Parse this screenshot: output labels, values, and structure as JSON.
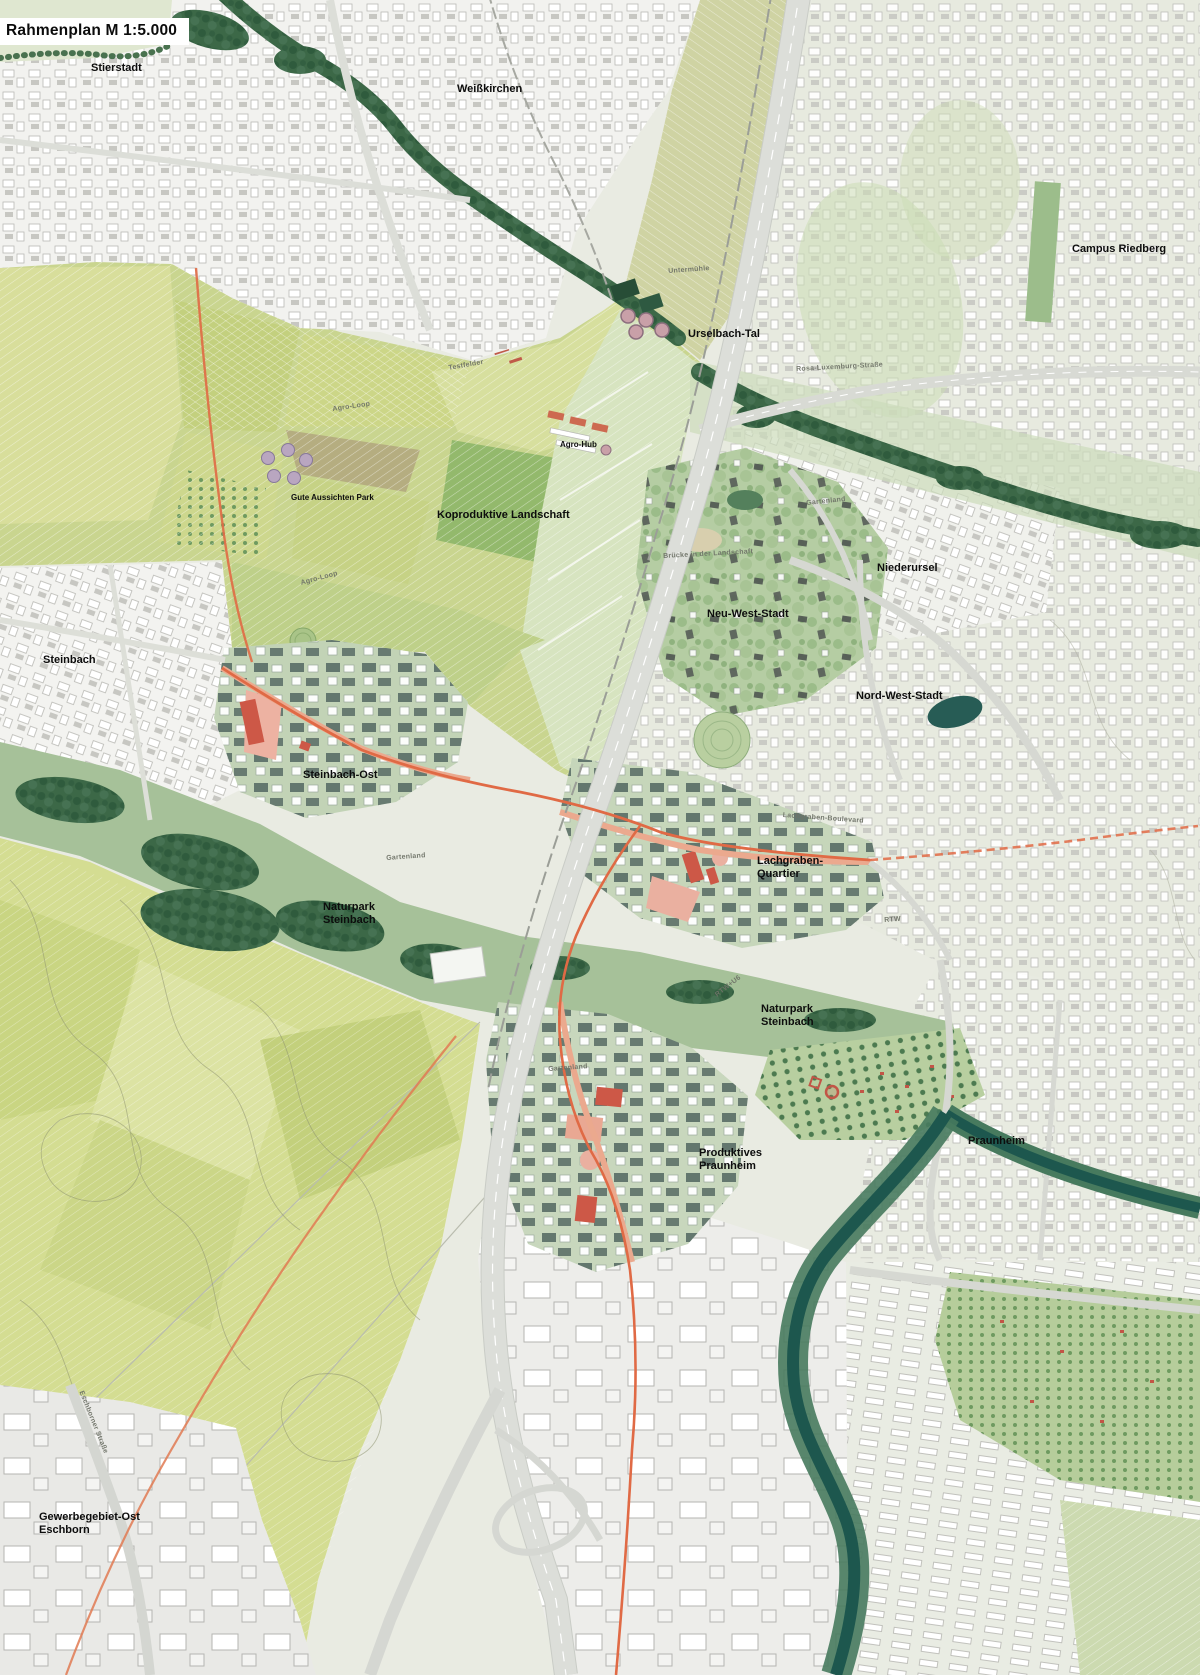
{
  "title": "Rahmenplan M 1:5.000",
  "labels": {
    "stierstadt": "Stierstadt",
    "weisskirchen": "Weißkirchen",
    "campus_riedberg": "Campus Riedberg",
    "urselbach_tal": "Urselbach-Tal",
    "agro_hub": "Agro-Hub",
    "gute_aussichten_park": "Gute Aussichten Park",
    "koproduktive_landschaft": "Koproduktive Landschaft",
    "niederursel": "Niederursel",
    "neu_west_stadt": "Neu-West-Stadt",
    "nord_west_stadt": "Nord-West-Stadt",
    "steinbach": "Steinbach",
    "steinbach_ost": "Steinbach-Ost",
    "lachgraben_quartier": "Lachgraben-\nQuartier",
    "naturpark_steinbach_west": "Naturpark\nSteinbach",
    "naturpark_steinbach_ost": "Naturpark\nSteinbach",
    "produktives_praunheim": "Produktives\nPraunheim",
    "praunheim": "Praunheim",
    "gewerbegebiet_ost_eschborn": "Gewerbegebiet-Ost\nEschborn"
  },
  "minor_labels": {
    "untermuehle": "Untermühle",
    "agro_loop_nord": "Agro-Loop",
    "agro_loop_sued": "Agro-Loop",
    "testfelder": "Testfelder",
    "gartenland_nord": "Gartenland",
    "gartenland_west": "Gartenland",
    "gartenland_sued": "Gartenland",
    "bruecke_landschaft": "Brücke in der Landschaft",
    "lachgraben_boulevard": "Lachgraben-Boulevard",
    "rtw": "RTW",
    "rtw_u6": "RTW+U6",
    "rosa_luxemburg_strasse": "Rosa-Luxemburg-Straße",
    "eschborner_strasse": "Eschborner Straße"
  },
  "colors": {
    "route_orange": "#e06a45",
    "new_quarter_red": "#cd5847",
    "forest_green": "#3c6847",
    "river_teal": "#1d574e",
    "field_green": "#c9d58f",
    "highway_gray": "#dcded9"
  }
}
